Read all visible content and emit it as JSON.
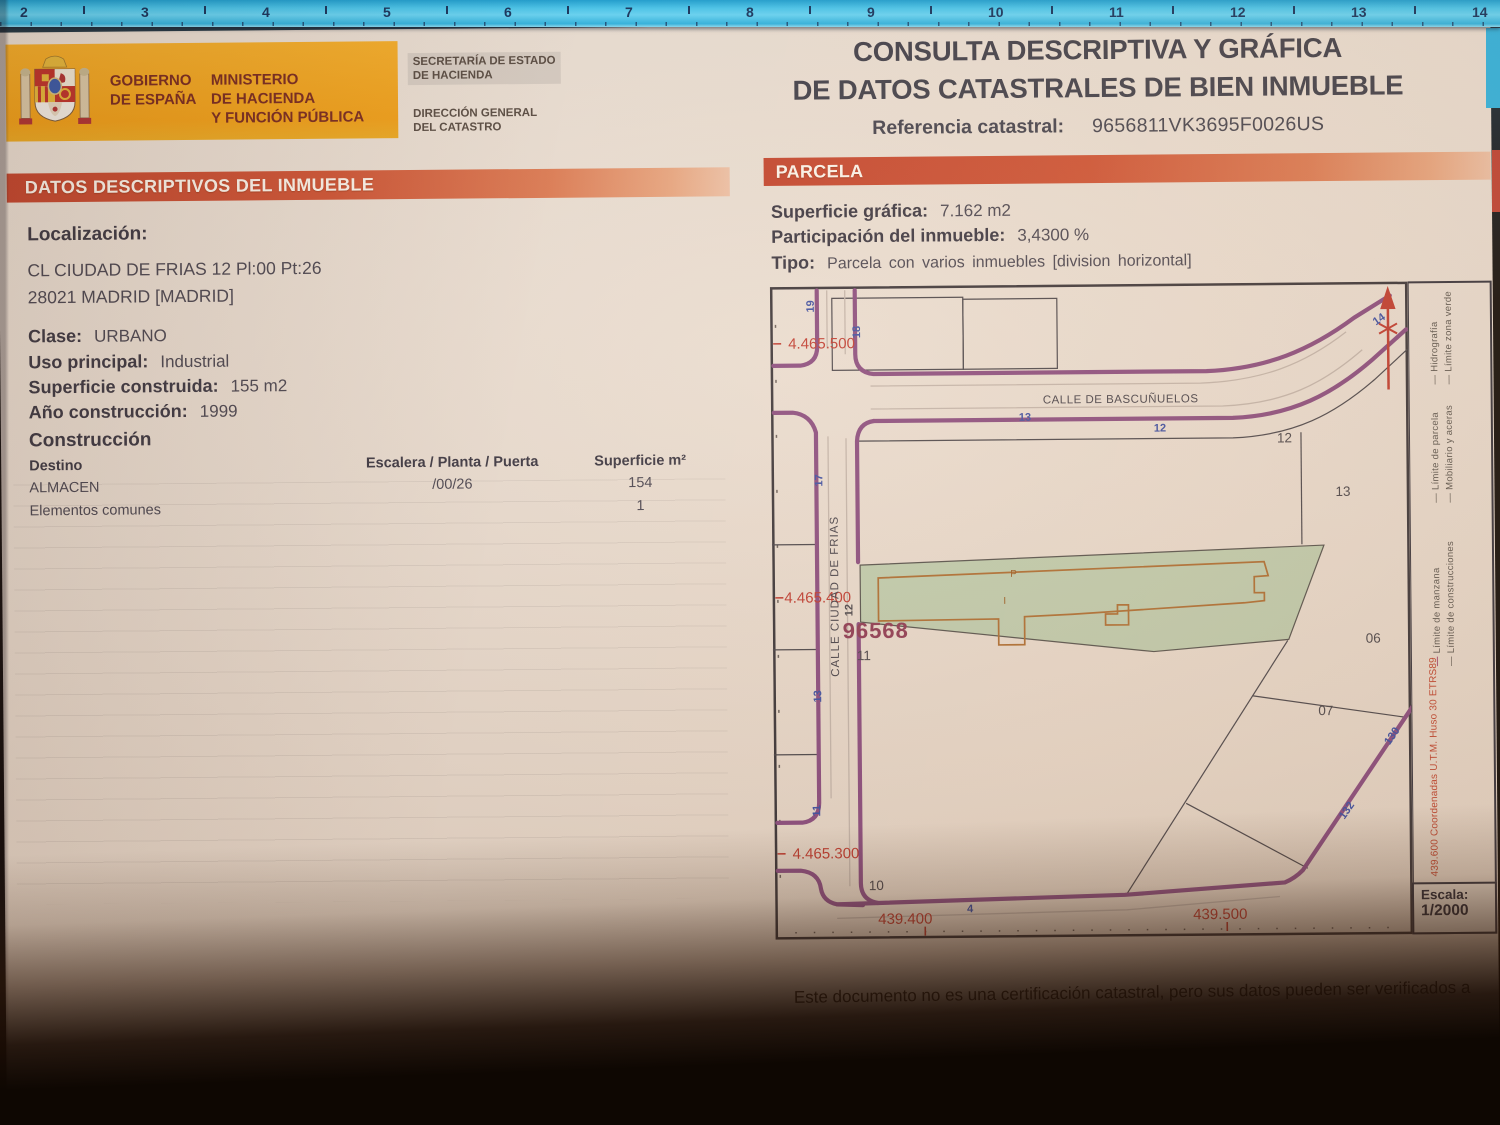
{
  "ruler": {
    "numbers": [
      "2",
      "3",
      "4",
      "5",
      "6",
      "7",
      "8",
      "9",
      "10",
      "11",
      "12",
      "13",
      "14"
    ]
  },
  "header": {
    "gov_line1": "GOBIERNO",
    "gov_line2": "DE ESPAÑA",
    "ministry_line1": "MINISTERIO",
    "ministry_line2": "DE HACIENDA",
    "ministry_line3": "Y FUNCIÓN PÚBLICA",
    "secretaria_line1": "SECRETARÍA DE ESTADO",
    "secretaria_line2": "DE HACIENDA",
    "direccion_line1": "DIRECCIÓN GENERAL",
    "direccion_line2": "DEL CATASTRO",
    "title_line1": "CONSULTA DESCRIPTIVA Y GRÁFICA",
    "title_line2": "DE DATOS CATASTRALES DE BIEN INMUEBLE",
    "referencia_label": "Referencia catastral:",
    "referencia_value": "9656811VK3695F0026US"
  },
  "datos": {
    "section_title": "DATOS DESCRIPTIVOS DEL INMUEBLE",
    "localizacion_label": "Localización:",
    "address_line1": "CL CIUDAD DE FRIAS 12 Pl:00 Pt:26",
    "address_line2": "28021 MADRID [MADRID]",
    "clase_label": "Clase:",
    "clase_value": "URBANO",
    "uso_label": "Uso principal:",
    "uso_value": "Industrial",
    "superficie_label": "Superficie construida:",
    "superficie_value": "155 m2",
    "anio_label": "Año construcción:",
    "anio_value": "1999",
    "construccion_title": "Construcción",
    "col_destino": "Destino",
    "col_escalera": "Escalera / Planta / Puerta",
    "col_superficie": "Superficie m²",
    "rows": [
      {
        "destino": "ALMACEN",
        "escalera": "/00/26",
        "superficie": "154"
      },
      {
        "destino": "Elementos comunes",
        "escalera": "",
        "superficie": "1"
      }
    ]
  },
  "parcela": {
    "section_title": "PARCELA",
    "superficie_label": "Superficie gráfica:",
    "superficie_value": "7.162 m2",
    "participacion_label": "Participación del inmueble:",
    "participacion_value": "3,4300 %",
    "tipo_label": "Tipo:",
    "tipo_value": "Parcela con varios inmuebles [division horizontal]"
  },
  "map": {
    "street_bascunuelos": "CALLE DE BASCUÑUELOS",
    "street_ciudad_de_frias": "CALLE CIUDAD DE FRIAS",
    "manzana_number": "96568",
    "coord_y_top": "4.465.500",
    "coord_y_mid": "4.465.400",
    "coord_y_bottom": "4.465.300",
    "coord_x_left": "439.400",
    "coord_x_right": "439.500",
    "parcels": {
      "p06": "06",
      "p07": "07",
      "p10": "10",
      "p11": "11",
      "p12": "12",
      "p13": "13"
    },
    "street_numbers": {
      "n19": "19",
      "n18": "18",
      "n17": "17",
      "n14": "14",
      "n13": "13",
      "n12": "12",
      "n12b": "12",
      "n11": "11",
      "n4": "4",
      "n130": "130",
      "n132": "132"
    },
    "building_marks": {
      "p": "P",
      "i": "I"
    },
    "escala_label": "Escala:",
    "escala_value": "1/2000"
  },
  "legend": {
    "items": [
      {
        "symbol": "—",
        "label": "Hidrografía"
      },
      {
        "symbol": "—",
        "label": "Límite zona verde"
      },
      {
        "symbol": "—",
        "label": "Límite de parcela"
      },
      {
        "symbol": "—",
        "label": "Mobiliario y aceras"
      },
      {
        "symbol": "—",
        "label": "Límite de manzana"
      },
      {
        "symbol": "—",
        "label": "Límite de construcciones"
      }
    ],
    "coord_note": "439.600 Coordenadas U.T.M. Huso 30 ETRS89"
  },
  "footer": {
    "disclaimer": "Este documento no es una certificación catastral, pero sus datos pueden ser verificados a"
  }
}
